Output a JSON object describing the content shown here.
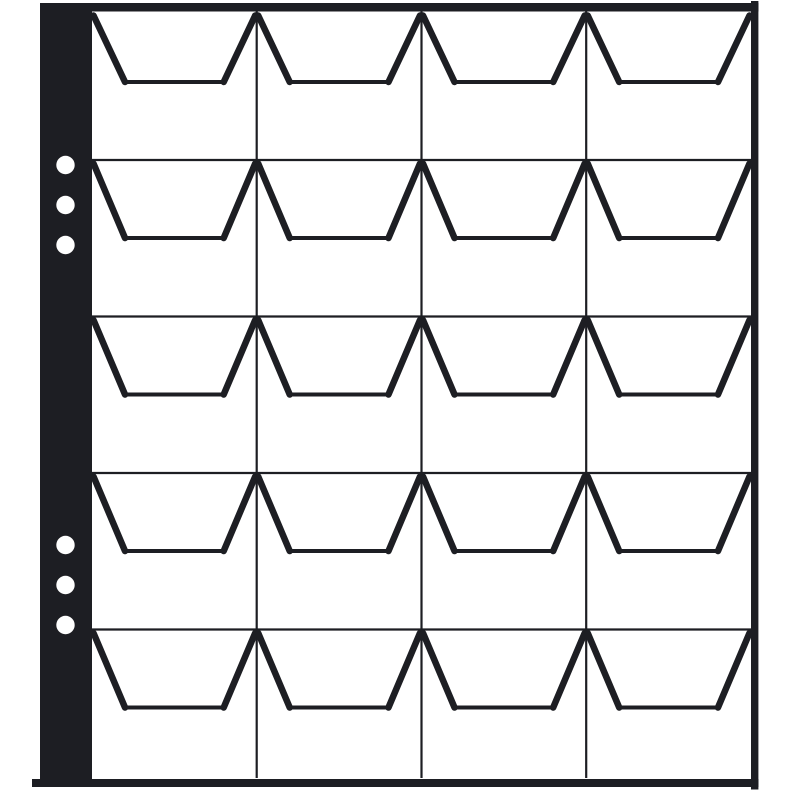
{
  "meta": {
    "description": "Line-art product illustration of a binder pocket page (coin album sheet) with 20 open pockets",
    "background_color": "#ffffff",
    "ink_color": "#1d1e23"
  },
  "page": {
    "grid": {
      "rows": 5,
      "columns": 4,
      "pocket_count": 20
    },
    "binder_strip": {
      "side": "left",
      "hole_groups": [
        {
          "position": "top",
          "count": 3
        },
        {
          "position": "bottom",
          "count": 3
        }
      ],
      "total_holes": 6
    },
    "edges": {
      "top_bar": true,
      "right_bar": true,
      "bottom_bar": true
    }
  }
}
